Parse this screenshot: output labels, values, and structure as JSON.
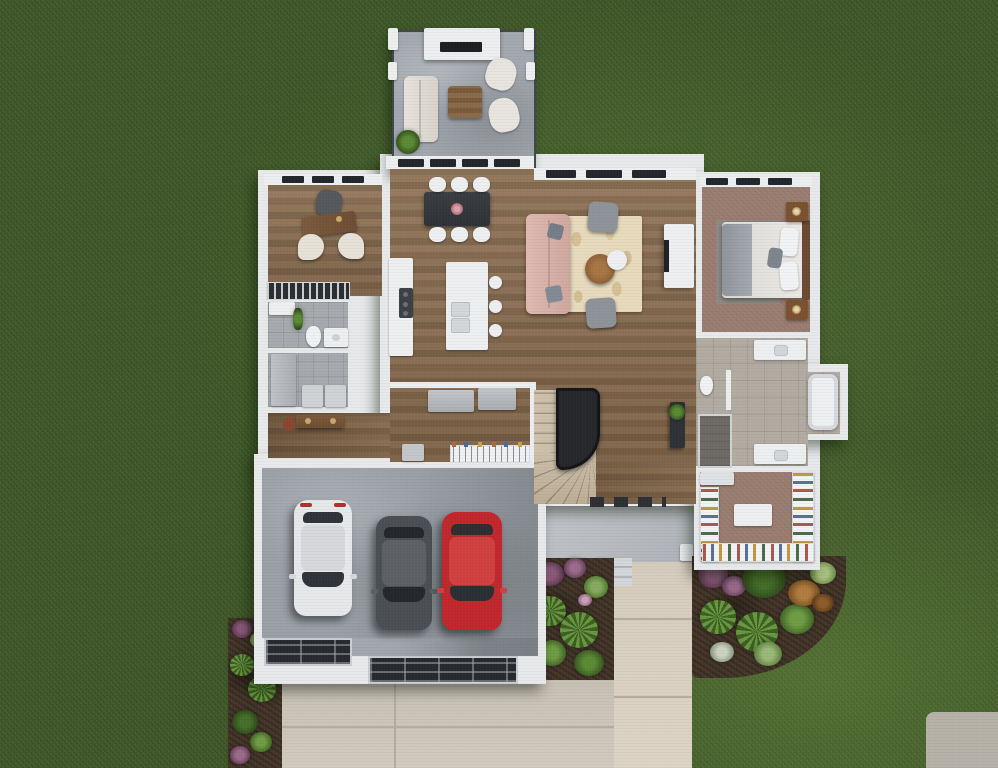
{
  "meta": {
    "kind": "photoreal 3D aerial floor-plan rendering",
    "setting": "single-story home footprint viewed straight down on a green lawn",
    "visible_text": "none"
  },
  "palette": {
    "grass": "#41592a",
    "grass_light": "#5d8136",
    "wall_white": "#e7e9eb",
    "wood_floor": "#8a6e50",
    "deck_concrete": "#a3a8af",
    "garage_concrete": "#9aa0a6",
    "tile_gray": "#a6aaae",
    "tile_beige": "#b2aba2",
    "carpet_mauve": "#9c7f71",
    "driveway": "#ccc5bb",
    "walkway": "#d9d0c3",
    "garden_soil": "#45362a",
    "stair_rail": "#17191c"
  },
  "rooms": [
    {
      "id": "deck",
      "label": "Rear deck with outdoor lounge set and fireplace"
    },
    {
      "id": "office",
      "label": "Home office with desk and two guest chairs"
    },
    {
      "id": "powder-bath",
      "label": "Powder bathroom with toilet and vanity"
    },
    {
      "id": "laundry",
      "label": "Laundry room with washer, dryer and cabinet"
    },
    {
      "id": "dining",
      "label": "Dining area with table for six"
    },
    {
      "id": "kitchen",
      "label": "Kitchen with island and three stools"
    },
    {
      "id": "living",
      "label": "Living room with sofa, rug, fireplace"
    },
    {
      "id": "bedroom",
      "label": "Primary bedroom with bed and nightstands"
    },
    {
      "id": "master-bath",
      "label": "Primary bath with double vanities, tub, shower"
    },
    {
      "id": "closet",
      "label": "Walk-in closet with island and wardrobes"
    },
    {
      "id": "mudroom",
      "label": "Mudroom with cabinets and coat rail"
    },
    {
      "id": "stairs",
      "label": "Curved staircase with black railing"
    },
    {
      "id": "garage",
      "label": "Three-car garage"
    },
    {
      "id": "porch",
      "label": "Front porch with step"
    },
    {
      "id": "walkway",
      "label": "Front walkway"
    },
    {
      "id": "driveway",
      "label": "Concrete driveway with two garage doors"
    },
    {
      "id": "gardens",
      "label": "Landscaped garden beds with ferns and flowers"
    }
  ],
  "vehicles": [
    {
      "id": "white-car",
      "color": "#e7e8ea",
      "roof": "#d6d8db",
      "glass": "#30343a"
    },
    {
      "id": "gray-car",
      "color": "#4b4f54",
      "roof": "#5d6166",
      "glass": "#24272b"
    },
    {
      "id": "red-car",
      "color": "#c1272d",
      "roof": "#d04040",
      "glass": "#2b2e33"
    }
  ],
  "furniture": {
    "deck": [
      "outdoor sofa",
      "two armchairs",
      "wood coffee table",
      "outdoor fireplace",
      "potted plant"
    ],
    "dining": [
      "dark rectangular table",
      "six white chairs",
      "centerpiece"
    ],
    "kitchen": [
      "wall counter with range",
      "white island",
      "three stools"
    ],
    "living": [
      "blush sofa",
      "two gray armchairs",
      "round wood coffee table",
      "white side table",
      "patterned cream rug",
      "wall fireplace"
    ],
    "bedroom": [
      "upholstered bed",
      "two wood nightstands with lamps",
      "gray area rug"
    ],
    "master_bath": [
      "two vanities",
      "soaking tub",
      "water closet",
      "walk-in shower"
    ],
    "closet": [
      "center island",
      "hanging wardrobe shelving"
    ],
    "garage": [
      "white car",
      "gray car",
      "red car"
    ]
  }
}
